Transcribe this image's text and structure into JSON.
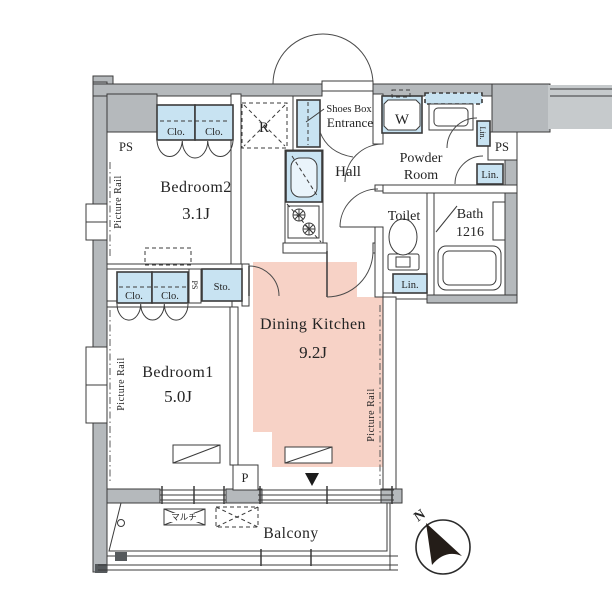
{
  "floorplan": {
    "rooms": {
      "bedroom2": {
        "label": "Bedroom2",
        "area": "3.1J"
      },
      "bedroom1": {
        "label": "Bedroom1",
        "area": "5.0J"
      },
      "dining_kitchen": {
        "label": "Dining Kitchen",
        "area": "9.2J"
      },
      "hall": {
        "label": "Hall"
      },
      "entrance": {
        "label": "Entrance",
        "shoes_box": "Shoes Box"
      },
      "powder_room": {
        "line1": "Powder",
        "line2": "Room"
      },
      "toilet": {
        "label": "Toilet"
      },
      "bath": {
        "label": "Bath",
        "size": "1216"
      },
      "balcony": {
        "label": "Balcony"
      }
    },
    "fixtures": {
      "closet": "Clo.",
      "storage": "Sto.",
      "linen": "Lin.",
      "pipe_space": "PS",
      "refrigerator": "R",
      "washer": "W",
      "pillar": "P",
      "picture_rail": "Picture Rail",
      "multi_outlet": "マルチ"
    },
    "compass": {
      "north": "N"
    },
    "colors": {
      "wall_gray": "#b5b9bc",
      "fixture_blue": "#c8e3f2",
      "dk_highlight": "#f7d2c6",
      "line": "#3b3b3b"
    }
  }
}
